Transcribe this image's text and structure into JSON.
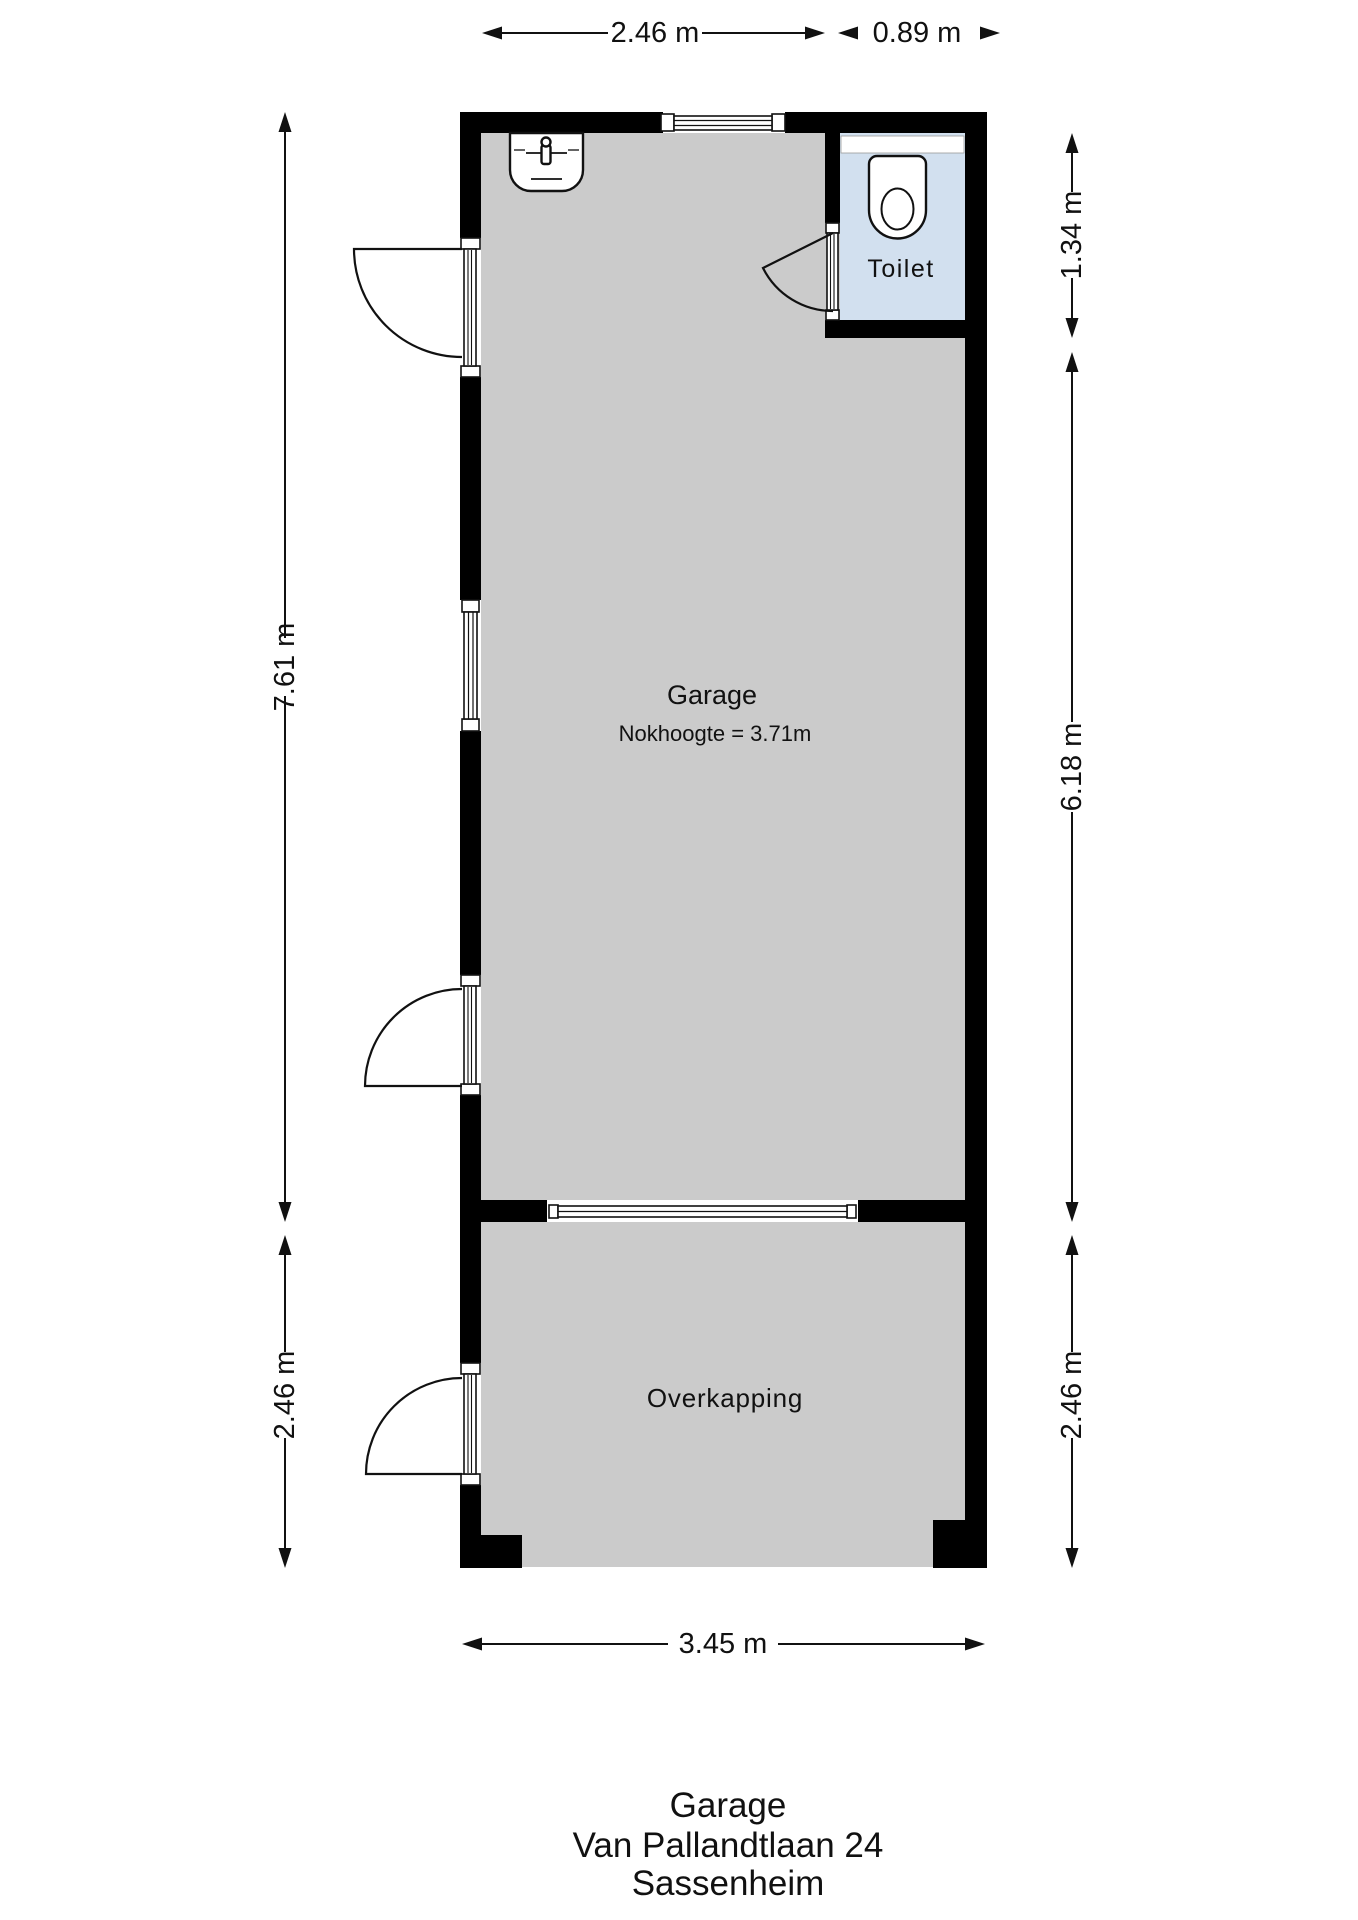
{
  "floorplan": {
    "rooms": {
      "garage": {
        "label": "Garage",
        "sublabel": "Nokhoogte = 3.71m"
      },
      "toilet": {
        "label": "Toilet"
      },
      "overkapping": {
        "label": "Overkapping"
      }
    },
    "dimensions": {
      "top_width_garage": "2.46 m",
      "top_width_toilet": "0.89 m",
      "left_height_garage": "7.61 m",
      "left_height_overkapping": "2.46 m",
      "right_height_toilet": "1.34 m",
      "right_height_garage": "6.18 m",
      "right_height_overkapping": "2.46 m",
      "bottom_width": "3.45 m"
    },
    "colors": {
      "wall": "#000000",
      "floor": "#cbcbcb",
      "toilet_floor": "#d2e0ef",
      "line": "#111111"
    }
  },
  "title_block": {
    "line1": "Garage",
    "line2": "Van Pallandtlaan 24",
    "line3": "Sassenheim"
  }
}
